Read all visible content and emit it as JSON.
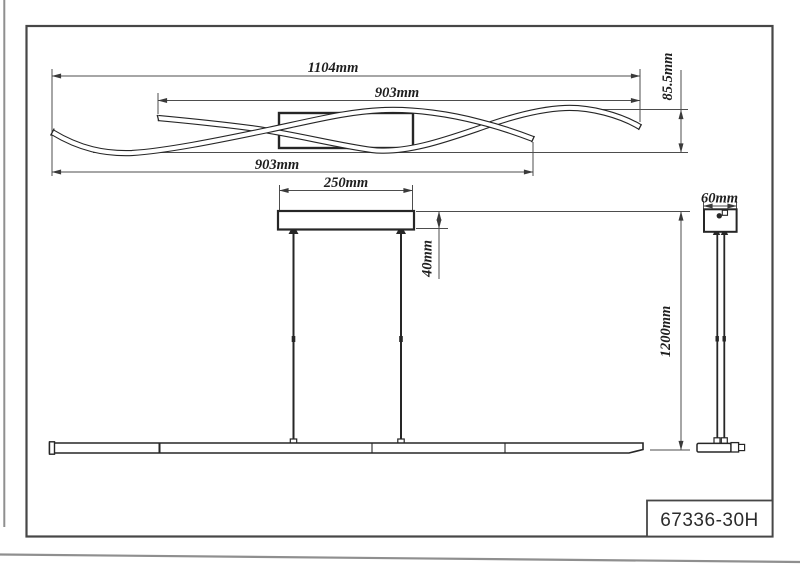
{
  "page": {
    "title_block": {
      "part_number": "67336-30H"
    },
    "views": {
      "top_view": {
        "label": "wave-light-bars-profile",
        "dim_total_width": "1104mm",
        "dim_right_wave": "903mm",
        "dim_left_wave": "903mm",
        "dim_wave_height": "85.5mm"
      },
      "front_view": {
        "label": "pendant-front-elevation",
        "dim_canopy_width": "250mm",
        "dim_canopy_height": "40mm",
        "dim_suspension_drop": "1200mm"
      },
      "side_view": {
        "label": "pendant-side-elevation",
        "dim_canopy_depth": "60mm"
      }
    },
    "colors": {
      "drawing_line": "#262626",
      "dimension_line": "#4d4d4d",
      "frame": "#474747",
      "page_edge": "#8f8f8f",
      "background": "#ffffff"
    }
  }
}
